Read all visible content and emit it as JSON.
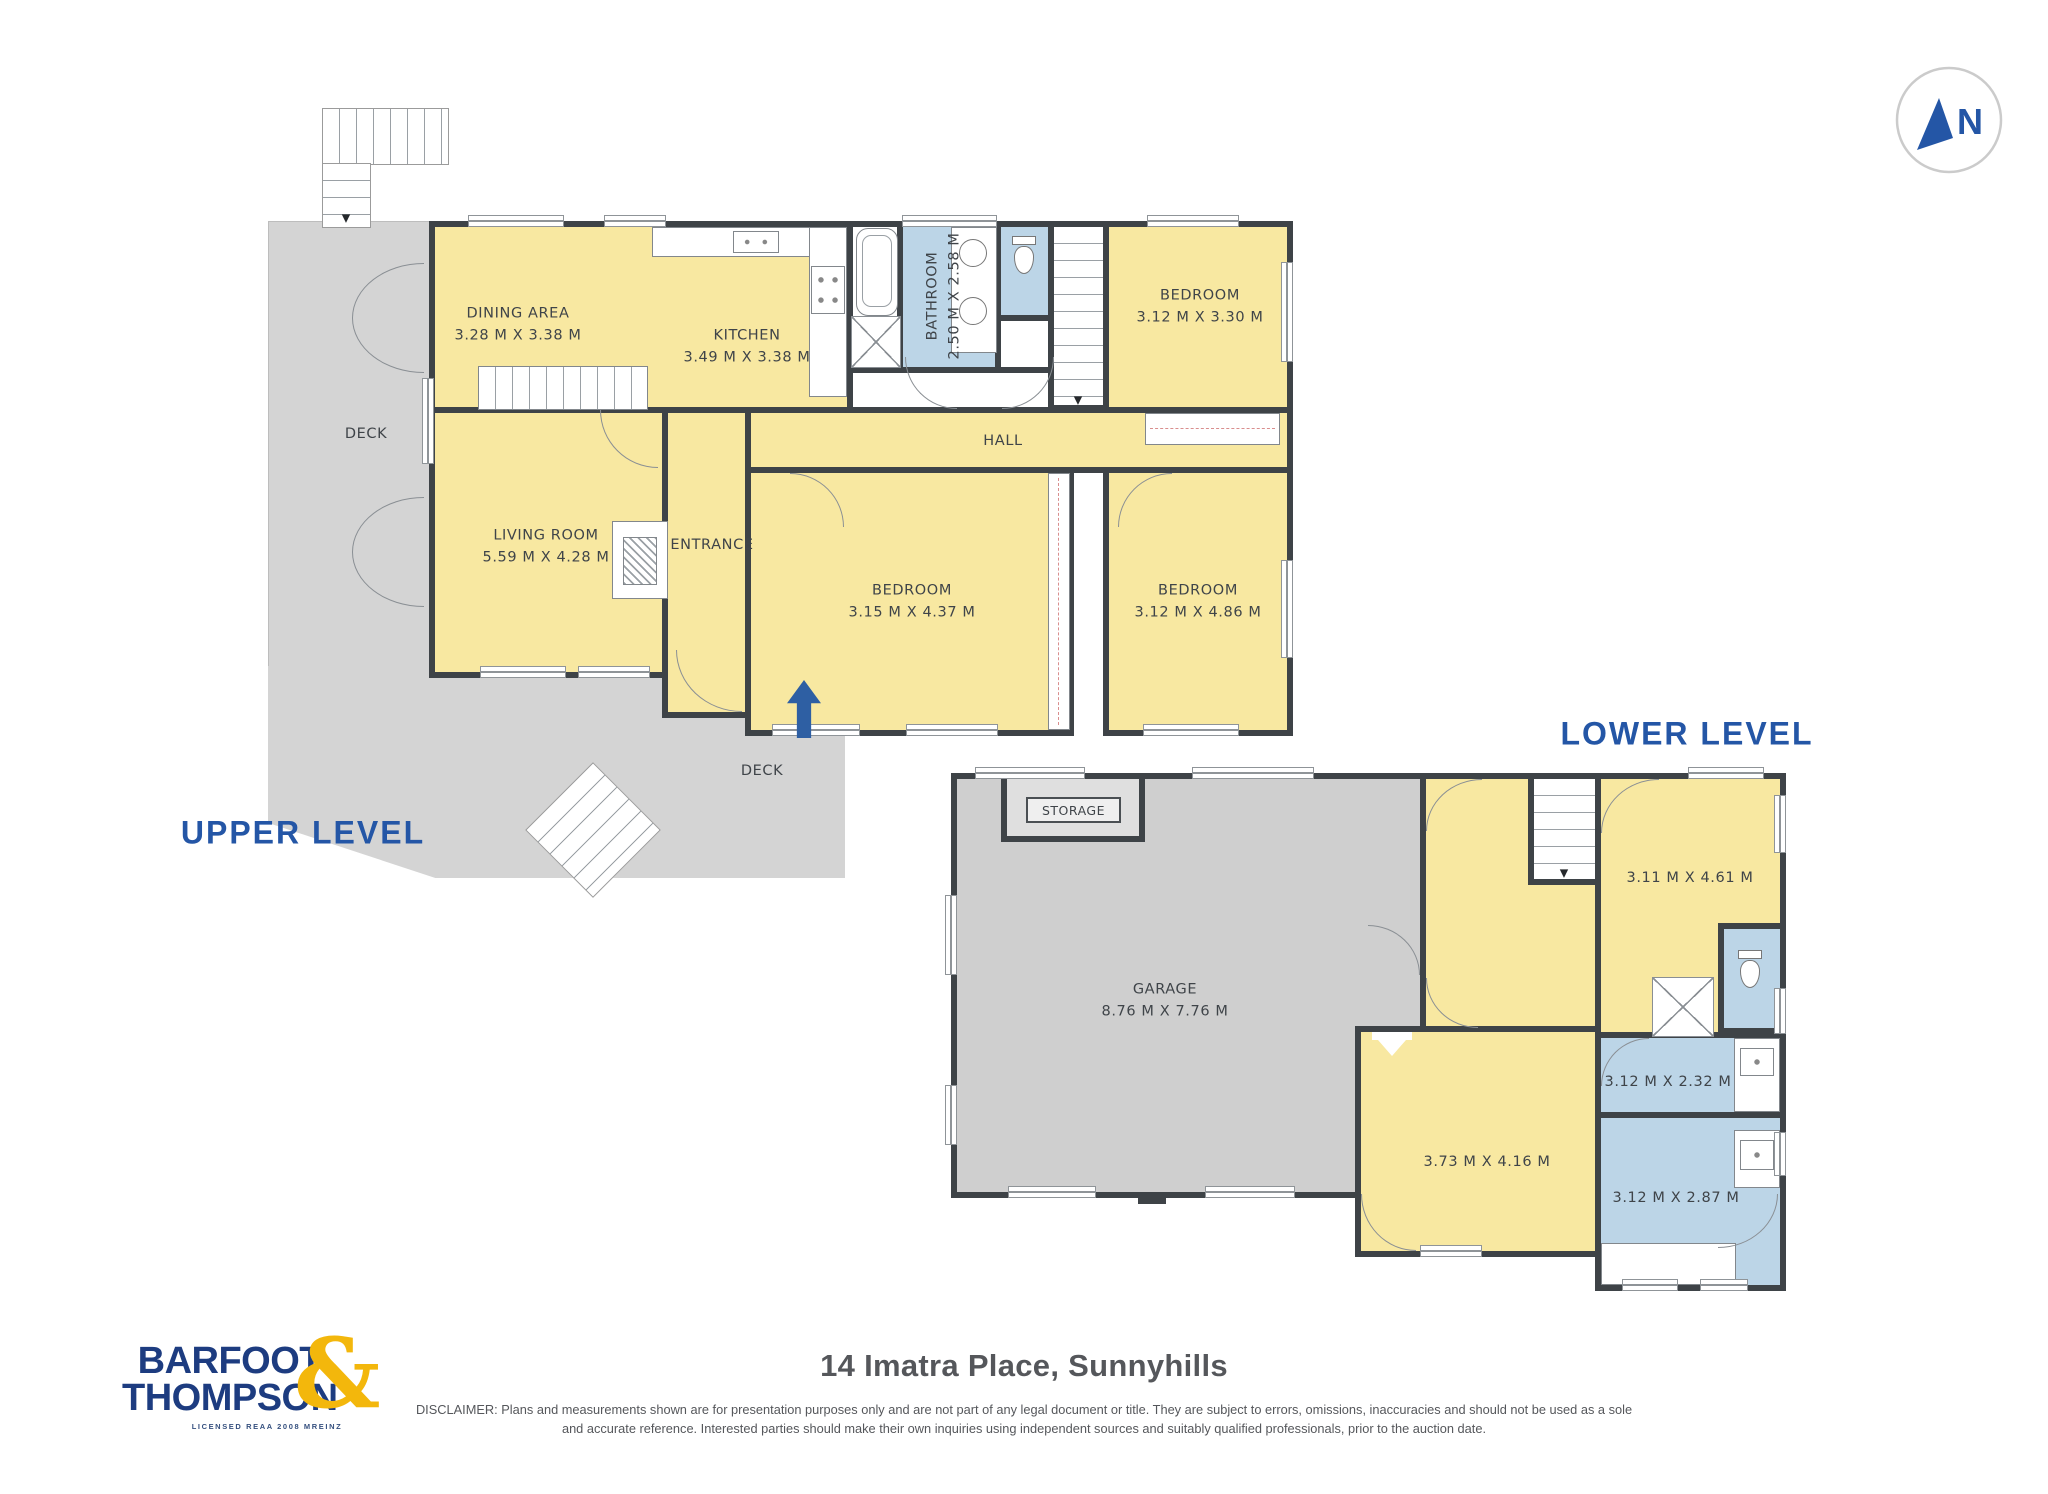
{
  "page": {
    "title": "14 Imatra Place, Sunnyhills",
    "disclaimer": "DISCLAIMER: Plans and measurements shown are for presentation purposes only and are not part of any legal document or title. They are subject to errors, omissions, inaccuracies and should not be used as a sole and accurate reference. Interested parties should make their own inquiries using independent sources and suitably qualified professionals, prior to the auction date."
  },
  "branding": {
    "name_line1": "BARFOOT",
    "name_line2": "THOMPSON",
    "ampersand": "&",
    "license": "LICENSED REAA 2008 MREINZ",
    "navy": "#1D3C80",
    "gold": "#F3B70C"
  },
  "compass": {
    "label": "N"
  },
  "icons": {
    "stairs_down_arrow": "▼"
  },
  "colors": {
    "room_yellow": "#F8E8A1",
    "wet_blue": "#BCD5E7",
    "deck_gray": "#D4D4D4",
    "garage_gray": "#CFCFCF",
    "wall": "#3E4347",
    "heading_blue": "#2456A6"
  },
  "upper_level": {
    "title": "UPPER LEVEL",
    "rooms": {
      "dining": {
        "name": "DINING AREA",
        "dims": "3.28 M X 3.38 M"
      },
      "kitchen": {
        "name": "KITCHEN",
        "dims": "3.49 M X 3.38 M"
      },
      "bathroom": {
        "name": "BATHROOM",
        "dims": "2.50 M X 2.58 M"
      },
      "bedroom_top": {
        "name": "BEDROOM",
        "dims": "3.12 M X 3.30 M"
      },
      "hall": {
        "name": "HALL"
      },
      "living": {
        "name": "LIVING ROOM",
        "dims": "5.59 M X 4.28 M"
      },
      "entrance": {
        "name": "ENTRANCE"
      },
      "bedroom_mid": {
        "name": "BEDROOM",
        "dims": "3.15 M X 4.37 M"
      },
      "bedroom_right": {
        "name": "BEDROOM",
        "dims": "3.12 M X 4.86 M"
      },
      "deck": {
        "name": "DECK"
      }
    }
  },
  "lower_level": {
    "title": "LOWER LEVEL",
    "rooms": {
      "garage": {
        "name": "GARAGE",
        "dims": "8.76 M X 7.76 M"
      },
      "storage": {
        "name": "STORAGE"
      },
      "rumpus": {
        "dims": "3.11 M X 4.61 M"
      },
      "laundry": {
        "dims": "3.12 M X 2.32 M"
      },
      "bedroom": {
        "dims": "3.73 M X 4.16 M"
      },
      "bathroom": {
        "dims": "3.12 M X 2.87 M"
      }
    }
  }
}
